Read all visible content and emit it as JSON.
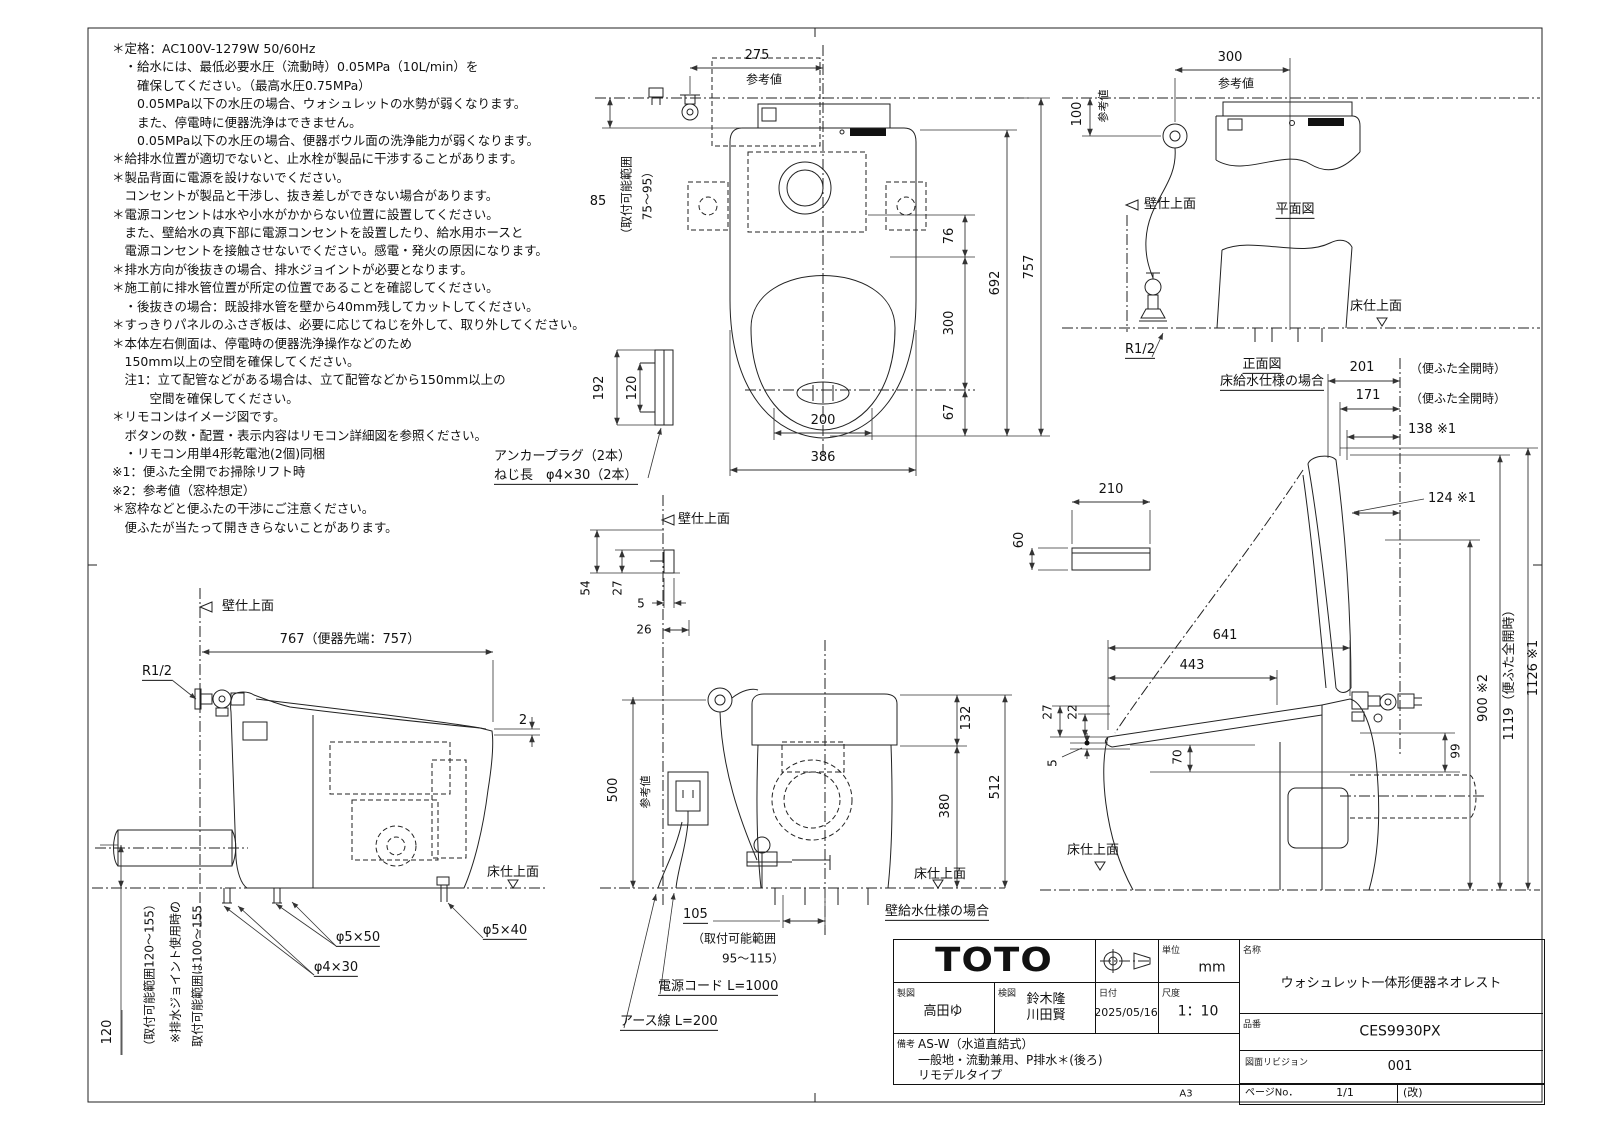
{
  "notes": {
    "lines": [
      "＊定格：AC100V-1279W 50/60Hz",
      "　・給水には、最低必要水圧（流動時）0.05MPa（10L/min）を",
      "　　確保してください。（最高水圧0.75MPa）",
      "　　0.05MPa以下の水圧の場合、ウォシュレットの水勢が弱くなります。",
      "　　また、停電時に便器洗浄はできません。",
      "　　0.05MPa以下の水圧の場合、便器ボウル面の洗浄能力が弱くなります。",
      "＊給排水位置が適切でないと、止水栓が製品に干渉することがあります。",
      "＊製品背面に電源を設けないでください。",
      "　コンセントが製品と干渉し、抜き差しができない場合があります。",
      "＊電源コンセントは水や小水がかからない位置に設置してください。",
      "　また、壁給水の真下部に電源コンセントを設置したり、給水用ホースと",
      "　電源コンセントを接触させないでください。感電・発火の原因になります。",
      "＊排水方向が後抜きの場合、排水ジョイントが必要となります。",
      "＊施工前に排水管位置が所定の位置であることを確認してください。",
      "　・後抜きの場合：既設排水管を壁から40mm残してカットしてください。",
      "＊すっきりパネルのふさぎ板は、必要に応じてねじを外して、取り外してください。",
      "＊本体左右側面は、停電時の便器洗浄操作などのため",
      "　150mm以上の空間を確保してください。",
      "　注1：立て配管などがある場合は、立て配管などから150mm以上の",
      "　　　空間を確保してください。",
      "＊リモコンはイメージ図です。",
      "　ボタンの数・配置・表示内容はリモコン詳細図を参照ください。",
      "　・リモコン用単4形乾電池(2個)同梱",
      "※1：便ふた全開でお掃除リフト時",
      "※2：参考値（窓枠想定）",
      "＊窓枠などと便ふたの干渉にご注意ください。",
      "　便ふたが当たって開ききらないことがあります。"
    ]
  },
  "plan": {
    "d275": "275",
    "ref": "参考値",
    "d85": "85",
    "range1": "（取付可能範囲",
    "range2": "75～95）",
    "d76": "76",
    "d300": "300",
    "d67": "67",
    "d692": "692",
    "d757": "757",
    "d200": "200",
    "d386": "386",
    "d192": "192",
    "d120": "120",
    "anchor1": "アンカープラグ（2本）",
    "anchor2": "ねじ長　φ4×30（2本）"
  },
  "topright": {
    "d300": "300",
    "ref": "参考値",
    "d100": "100",
    "ref100": "参考値",
    "wall": "壁仕上面",
    "plan_title": "平面図",
    "floor": "床仕上面",
    "r12": "R1/2",
    "front_title": "正面図",
    "front_sub": "床給水仕様の場合"
  },
  "side_open": {
    "d201": "201",
    "n201": "（便ふた全開時）",
    "d171": "171",
    "n171": "（便ふた全開時）",
    "d138": "138 ※1",
    "d124": "124 ※1",
    "d641": "641",
    "d443": "443",
    "d27": "27",
    "d22": "22",
    "d5": "5",
    "d70": "70",
    "d99": "99",
    "d900": "900 ※2",
    "d1119": "1119（便ふた全開時）",
    "d1126": "1126 ※1",
    "d210": "210",
    "d60": "60",
    "floor": "床仕上面"
  },
  "side_closed": {
    "wall": "壁仕上面",
    "r12": "R1/2",
    "d767": "767（便器先端：757）",
    "d2": "2",
    "d120": "120",
    "range1": "（取付可能範囲120～155）",
    "range2": "※排水ジョイント使用時の",
    "range3": "取付可能範囲は100～155",
    "s1": "φ5×50",
    "s2": "φ4×30",
    "s3": "φ5×40",
    "floor": "床仕上面"
  },
  "rear": {
    "wall": "壁仕上面",
    "d54": "54",
    "d27": "27",
    "d5": "5",
    "d26": "26",
    "d500": "500",
    "ref": "参考値",
    "d132": "132",
    "d380": "380",
    "d512": "512",
    "d105": "105",
    "range1": "（取付可能範囲",
    "range2": "95～115）",
    "power": "電源コード L=1000",
    "earth": "アース線 L=200",
    "floor": "床仕上面",
    "caption": "壁給水仕様の場合"
  },
  "title_block": {
    "logo": "TOTO",
    "unit_label": "単位",
    "unit": "mm",
    "drawn_label": "製図",
    "drawn": "高田ゆ",
    "checked_label": "検図",
    "checked": [
      "鈴木隆",
      "川田賢"
    ],
    "date_label": "日付",
    "date": "2025/05/16",
    "scale_label": "尺度",
    "scale": "1：10",
    "name_label": "名称",
    "name": "ウォシュレット一体形便器ネオレスト",
    "part_label": "品番",
    "part": "CES9930PX",
    "rev_label": "図面リビジョン",
    "rev": "001",
    "remarks_label": "備考",
    "remarks": [
      "AS-W（水道直結式）",
      "一般地・流動兼用、P排水＊(後ろ)",
      "リモデルタイプ"
    ],
    "size": "A3",
    "page_label": "ページNo．",
    "page": "1/1",
    "kai": "(改)"
  }
}
